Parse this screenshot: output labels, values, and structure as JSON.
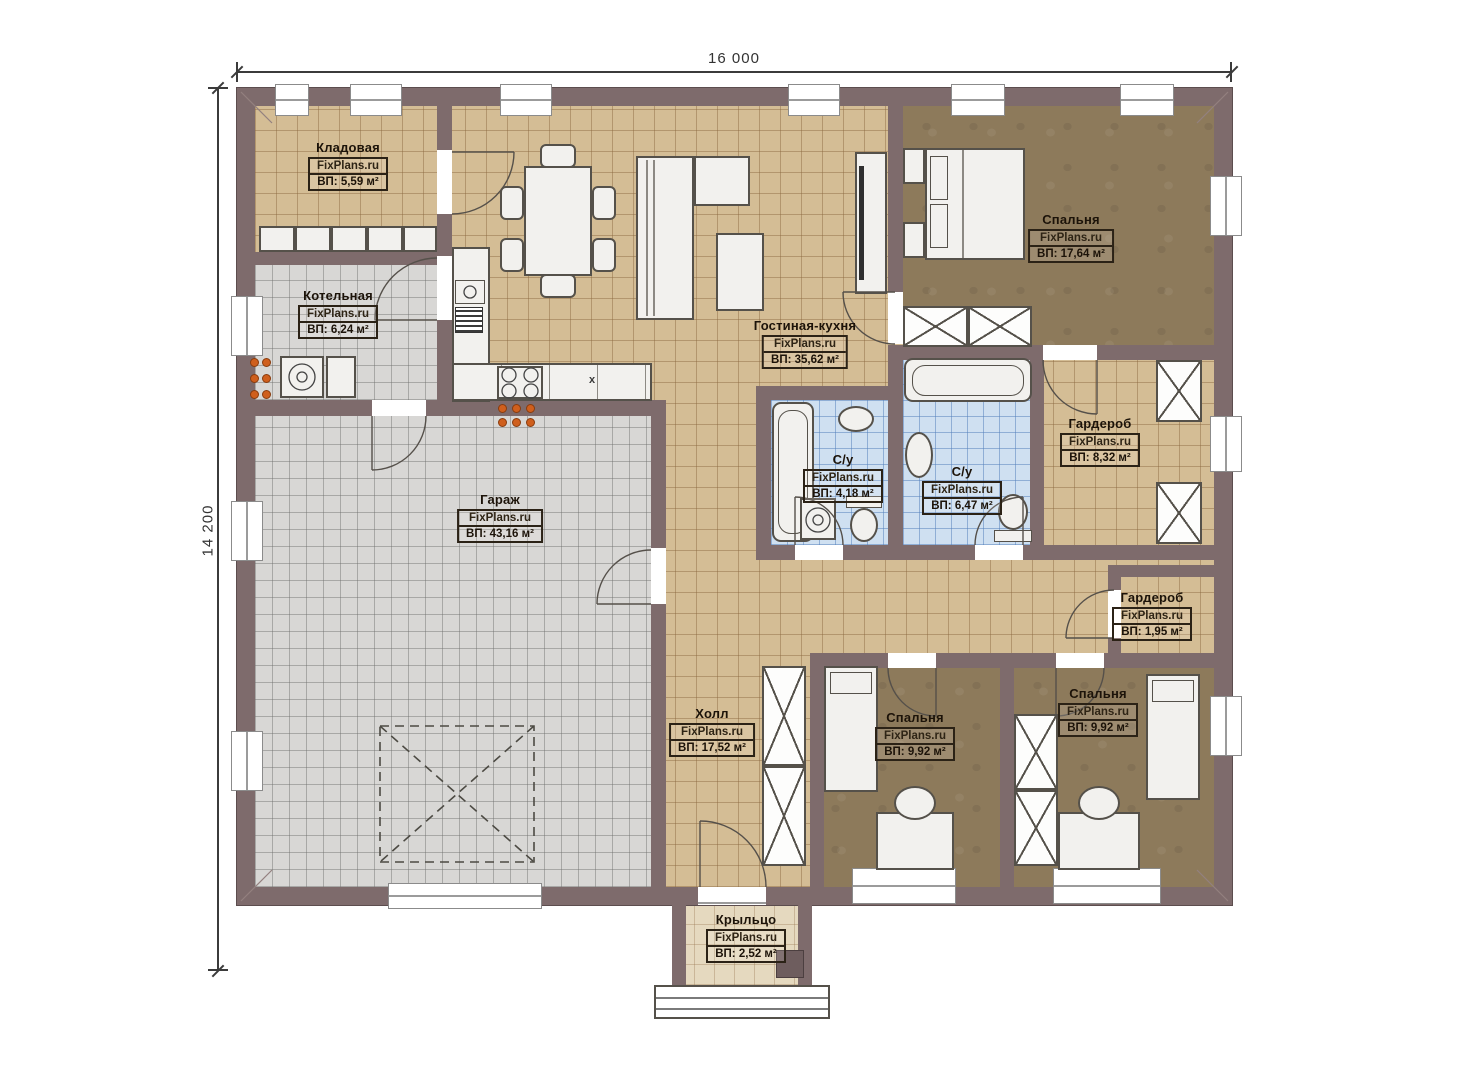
{
  "watermark": "FixPlans.ru",
  "dimensions": {
    "top": "16 000",
    "left": "14 200"
  },
  "rooms": [
    {
      "name": "Кладовая",
      "area": "ВП: 5,59 м²"
    },
    {
      "name": "Котельная",
      "area": "ВП: 6,24 м²"
    },
    {
      "name": "Гараж",
      "area": "ВП: 43,16 м²"
    },
    {
      "name": "Гостиная-кухня",
      "area": "ВП: 35,62 м²"
    },
    {
      "name": "Спальня",
      "area": "ВП: 17,64 м²"
    },
    {
      "name": "Гардероб",
      "area": "ВП: 8,32 м²"
    },
    {
      "name": "С/у",
      "area": "ВП: 4,18 м²"
    },
    {
      "name": "С/у",
      "area": "ВП: 6,47 м²"
    },
    {
      "name": "Гардероб",
      "area": "ВП: 1,95 м²"
    },
    {
      "name": "Холл",
      "area": "ВП: 17,52 м²"
    },
    {
      "name": "Спальня",
      "area": "ВП: 9,92 м²"
    },
    {
      "name": "Спальня",
      "area": "ВП: 9,92 м²"
    },
    {
      "name": "Крыльцо",
      "area": "ВП: 2,52 м²"
    }
  ],
  "kitchen": {
    "module_sign": "x"
  },
  "colors": {
    "wall": "#7e6b6c",
    "floor_tile": "#d4bd95",
    "floor_wood": "#8d7a5b",
    "floor_gray": "#d8d7d5",
    "floor_bath": "#cfe0f1",
    "floor_porch": "#e5d9bf",
    "utility_dots": "#cf5f1d"
  }
}
